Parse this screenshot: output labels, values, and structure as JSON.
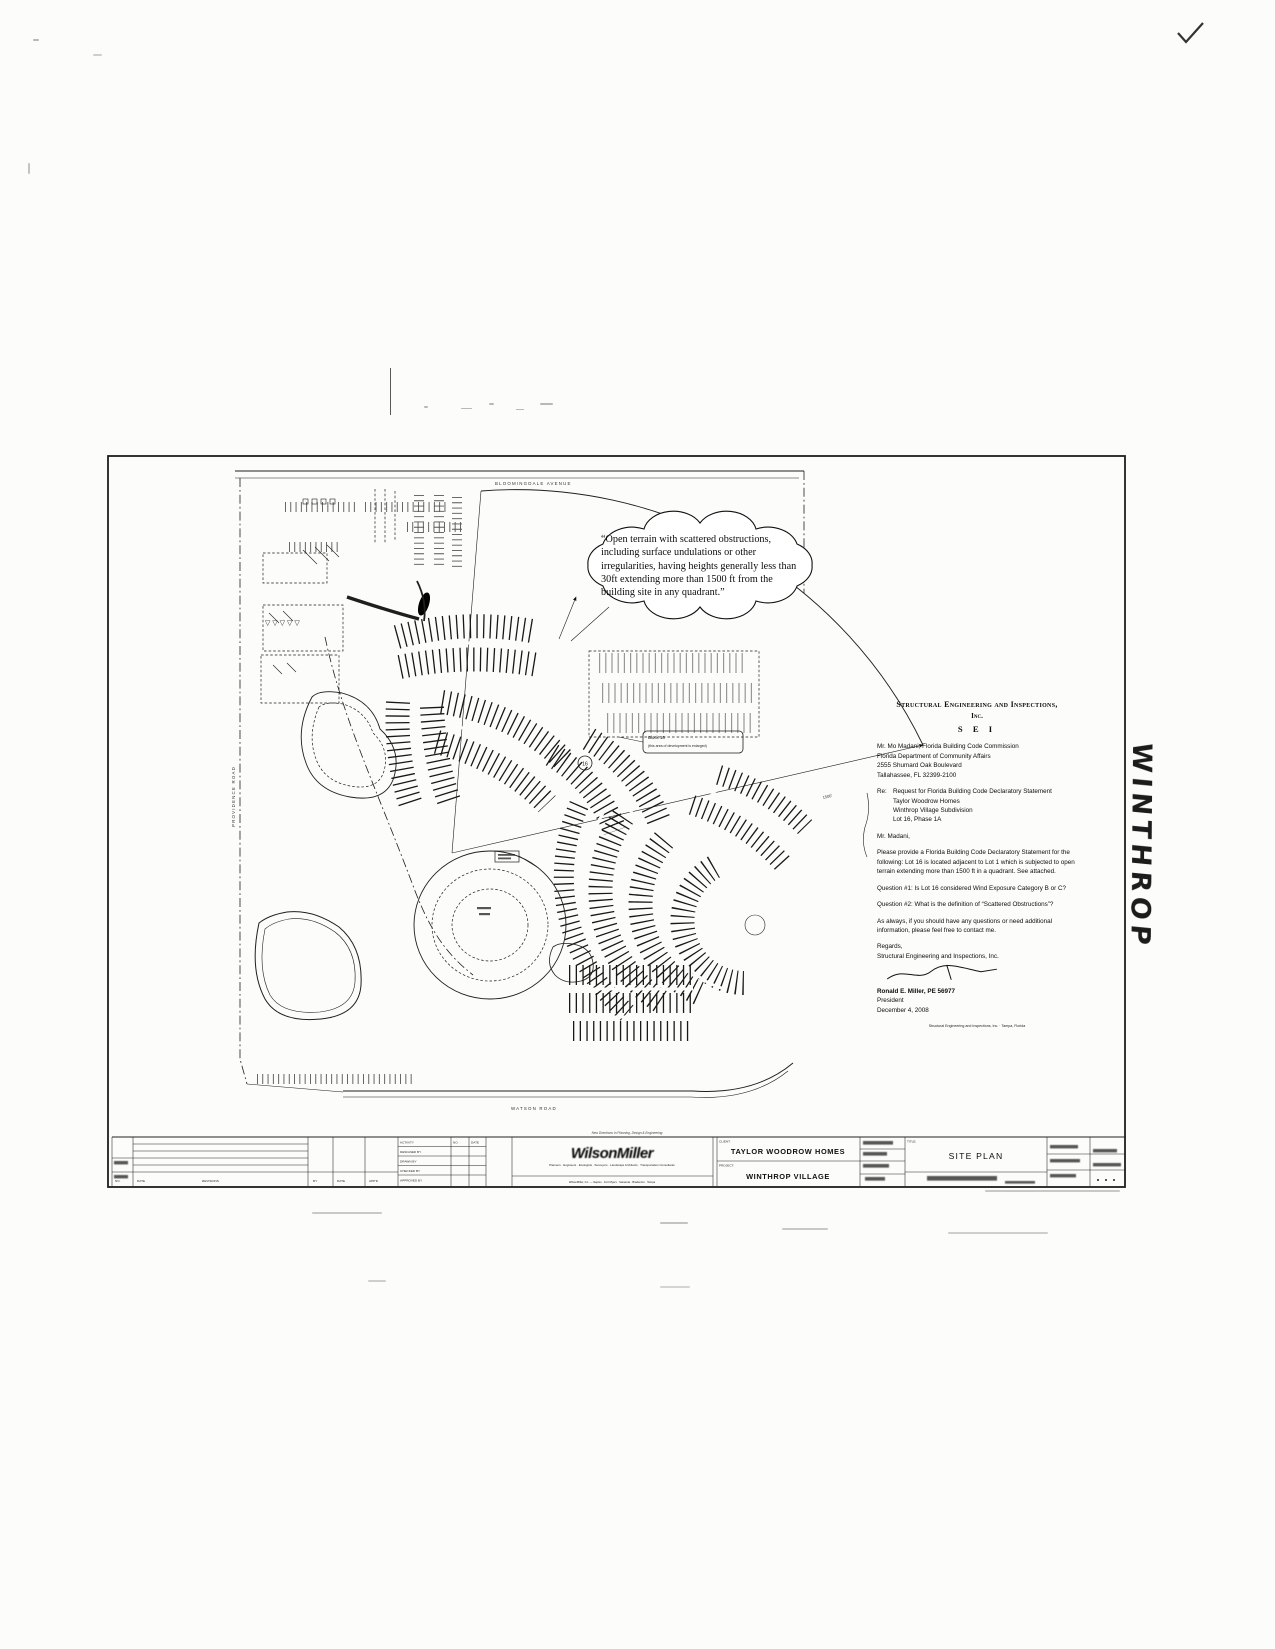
{
  "page": {
    "checkmark_note": "✓"
  },
  "margin_note": {
    "text": "WINTHROP"
  },
  "map": {
    "roads": {
      "top": "BLOOMINGDALE AVENUE",
      "left": "PROVIDENCE ROAD",
      "bottom": "WATSON ROAD"
    },
    "callout": "“Open terrain with scattered obstructions, including surface undulations or other irregularities, having heights generally less than 30ft extending more than 1500 ft from the building site in any quadrant.”",
    "radius_label": "1500'",
    "lot_circle_label": "16",
    "triangle_row": "▽ ▽ ▽ ▽ ▽",
    "note_box": {
      "line1": "Block 16",
      "line2": "(this area of development is enlarged)"
    }
  },
  "letter": {
    "firm_name": "Structural Engineering and Inspections,",
    "firm_inc": "Inc.",
    "firm_abbr": "S E I",
    "addressee": [
      "Mr. Mo Madani, Florida Building Code Commission",
      "Florida Department of Community Affairs",
      "2555 Shumard Oak Boulevard",
      "Tallahassee, FL 32399-2100"
    ],
    "re_label": "Re:",
    "re_lines": [
      "Request for Florida Building Code Declaratory Statement",
      "Taylor Woodrow Homes",
      "Winthrop Village Subdivision",
      "Lot 16, Phase 1A"
    ],
    "salutation": "Mr. Madani,",
    "para1": "Please provide a Florida Building Code Declaratory Statement for the following: Lot 16 is located adjacent to Lot 1 which is subjected to open terrain extending more than 1500 ft in a quadrant.  See attached.",
    "question1": "Question #1:  Is Lot 16 considered Wind Exposure Category B or C?",
    "question2": "Question #2:  What is the definition of “Scattered Obstructions”?",
    "para2": "As always, if you should have any questions or need additional information, please feel free to contact me.",
    "closing": "Regards,",
    "closing_firm": "Structural Engineering and Inspections, Inc.",
    "signer_name": "Ronald E. Miller, PE 56977",
    "signer_title": "President",
    "date": "December 4, 2008",
    "contact_line": "Structural Engineering and Inspections, Inc. · Tampa, Florida"
  },
  "title_block": {
    "client_label": "CLIENT:",
    "client": "TAYLOR WOODROW HOMES",
    "project_label": "PROJECT:",
    "project": "WINTHROP VILLAGE",
    "title_label": "TITLE:",
    "title": "SITE PLAN",
    "logo": "WilsonMiller",
    "tagline": "Planners · Engineers · Ecologists · Surveyors · Landscape Architects · Transportation Consultants",
    "address_line": "WilsonMiller, Inc. — Naples · Fort Myers · Sarasota · Bradenton · Tampa",
    "above_note": "New Directions In Planning, Design & Engineering",
    "activity_rows": [
      "ACTIVITY",
      "DESIGNED BY",
      "DRAWN BY",
      "CHECKED BY",
      "APPROVED BY"
    ],
    "activity_cols": [
      "NO.",
      "DATE"
    ],
    "rev_labels": [
      "NO.",
      "DATE",
      "REVISIONS",
      "BY",
      "DATE",
      "APP'D"
    ]
  }
}
